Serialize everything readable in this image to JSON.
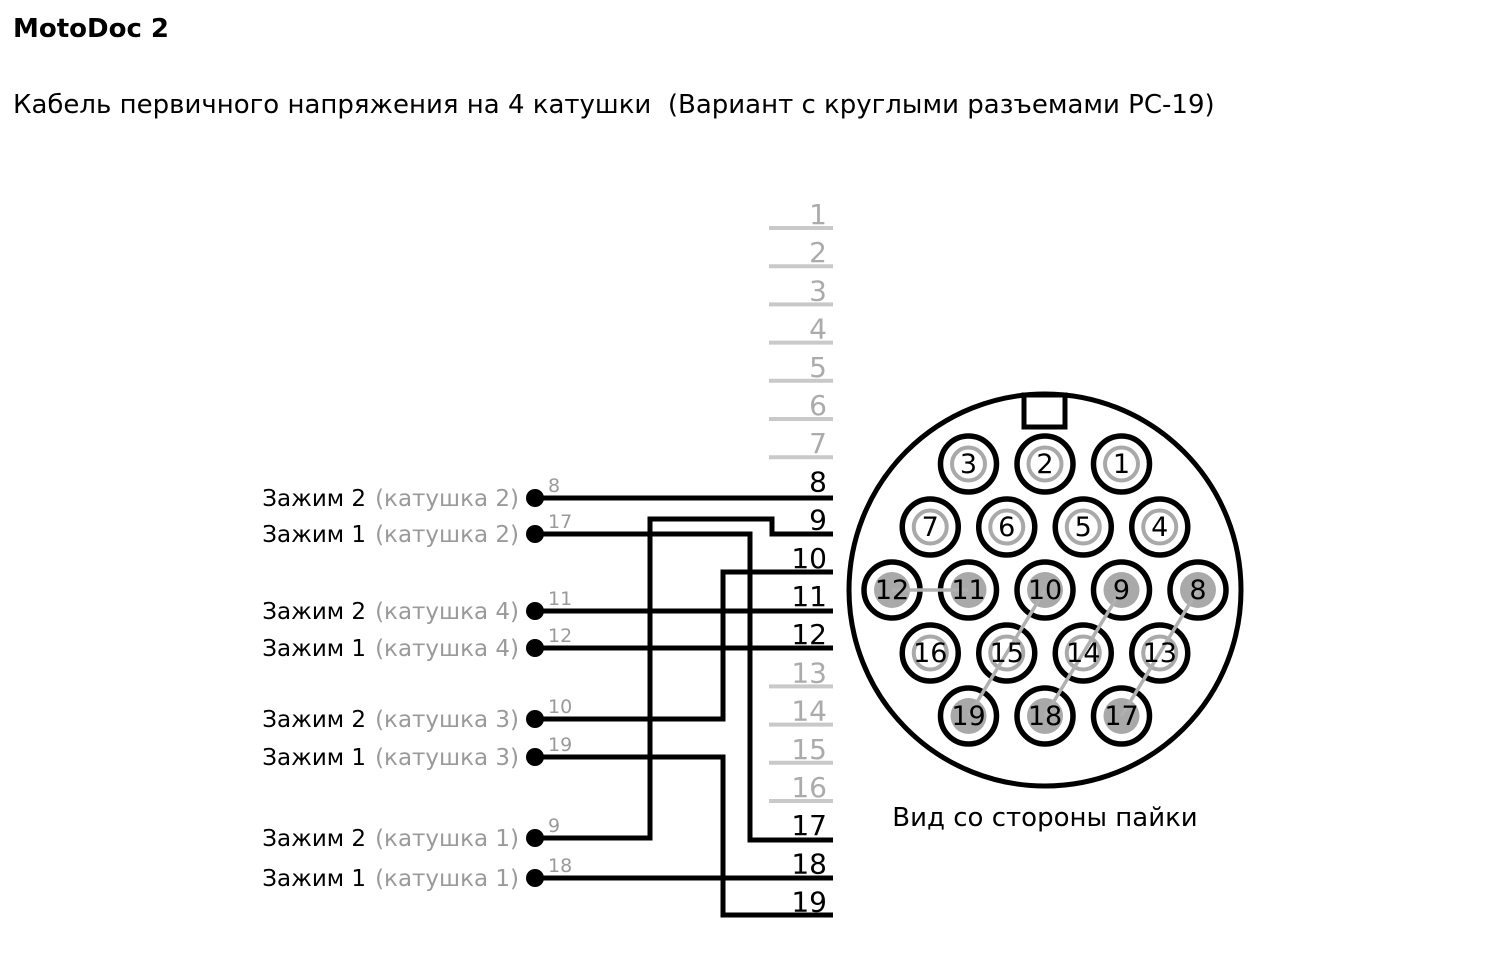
{
  "header": {
    "title": "MotoDoc 2",
    "subtitle": "Кабель первичного напряжения на 4 катушки  (Вариант с круглыми разъемами РС-19)"
  },
  "colors": {
    "wire_black": "#000000",
    "inactive_line_gray": "#c9c9c9",
    "inactive_number_gray": "#ababab",
    "label_gray": "#9a9a9a",
    "pin_gray": "#a9a9a9",
    "pair_link_gray": "#b0b0b0"
  },
  "left_terminals": [
    {
      "clamp": "Зажим 2",
      "coil": "(катушка 2)",
      "wire": "8"
    },
    {
      "clamp": "Зажим 1",
      "coil": "(катушка 2)",
      "wire": "17"
    },
    {
      "clamp": "Зажим 2",
      "coil": "(катушка 4)",
      "wire": "11"
    },
    {
      "clamp": "Зажим 1",
      "coil": "(катушка 4)",
      "wire": "12"
    },
    {
      "clamp": "Зажим 2",
      "coil": "(катушка 3)",
      "wire": "10"
    },
    {
      "clamp": "Зажим 1",
      "coil": "(катушка 3)",
      "wire": "19"
    },
    {
      "clamp": "Зажим 2",
      "coil": "(катушка 1)",
      "wire": "9"
    },
    {
      "clamp": "Зажим 1",
      "coil": "(катушка 1)",
      "wire": "18"
    }
  ],
  "terminal_strip": {
    "count": 19,
    "active_terminals": [
      8,
      9,
      10,
      11,
      12,
      17,
      18,
      19
    ]
  },
  "connector": {
    "caption": "Вид со стороны пайки",
    "pin_rows": [
      [
        3,
        2,
        1
      ],
      [
        7,
        6,
        5,
        4
      ],
      [
        12,
        11,
        10,
        9,
        8
      ],
      [
        16,
        15,
        14,
        13
      ],
      [
        19,
        18,
        17
      ]
    ],
    "soldered_pins": [
      8,
      9,
      10,
      11,
      12,
      17,
      18,
      19
    ],
    "pair_links": [
      [
        12,
        11
      ],
      [
        10,
        19
      ],
      [
        9,
        18
      ],
      [
        8,
        17
      ]
    ]
  }
}
